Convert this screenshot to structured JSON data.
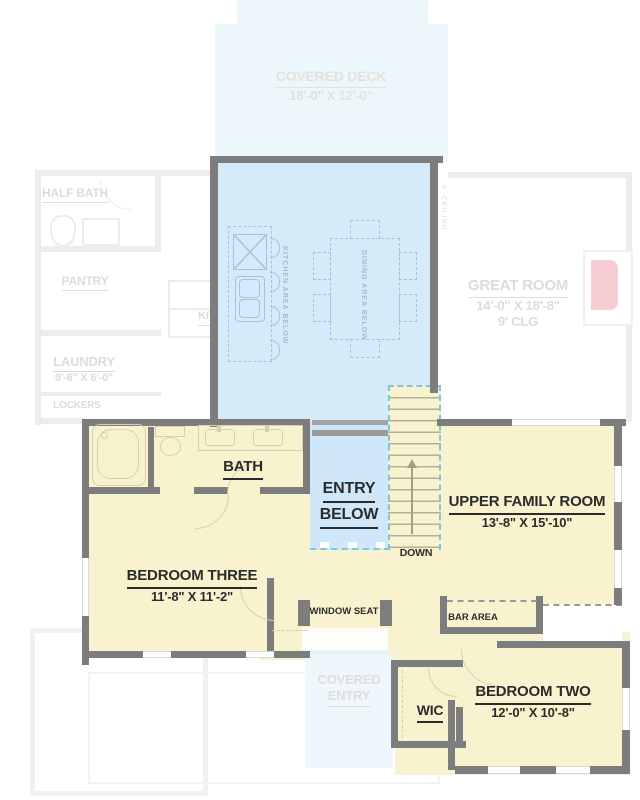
{
  "plan": {
    "covered_deck": {
      "name": "COVERED DECK",
      "dims": "18'-0\" X 12'-0\""
    },
    "half_bath": {
      "name": "HALF BATH"
    },
    "pantry": {
      "name": "PANTRY"
    },
    "laundry": {
      "name": "LAUNDRY",
      "dims": "9'-6\" X 6'-0\""
    },
    "lockers": {
      "name": "LOCKERS"
    },
    "kitchen": {
      "name": "KITCHEN"
    },
    "great_room": {
      "name": "GREAT ROOM",
      "dims": "14'-0\" X 18'-8\"",
      "ceiling": "9' CLG"
    },
    "ceiling_note": {
      "name": "9' CEILING"
    },
    "kitchen_area_below": {
      "name": "KITCHEN AREA BELOW"
    },
    "dining_area_below": {
      "name": "DINING AREA BELOW"
    },
    "entry_below": {
      "line1": "ENTRY",
      "line2": "BELOW"
    },
    "stairs": {
      "down": "DOWN"
    },
    "bath": {
      "name": "BATH"
    },
    "upper_family_room": {
      "name": "UPPER FAMILY ROOM",
      "dims": "13'-8\" X 15'-10\""
    },
    "bedroom_three": {
      "name": "BEDROOM THREE",
      "dims": "11'-8\" X 11'-2\""
    },
    "window_seat": {
      "name": "WINDOW SEAT"
    },
    "bar_area": {
      "name": "BAR AREA"
    },
    "covered_entry": {
      "line1": "COVERED",
      "line2": "ENTRY"
    },
    "wic": {
      "name": "WIC"
    },
    "bedroom_two": {
      "name": "BEDROOM TWO",
      "dims": "12'-0\" X 10'-8\""
    }
  },
  "colors": {
    "second_floor": "#f8f3ce",
    "open_below_blue": "#d6ebf9",
    "entry_blue": "#cfe7f8",
    "deck_blue": "#ecf7fc",
    "wall_gray": "#7d7d7d",
    "ghost": "#eeece8",
    "ghost_text": "#dfdcd6",
    "label_dark": "#2b2b2b",
    "teal_dash": "#7ec6d8",
    "fireplace_pink": "#f7ccd2"
  }
}
